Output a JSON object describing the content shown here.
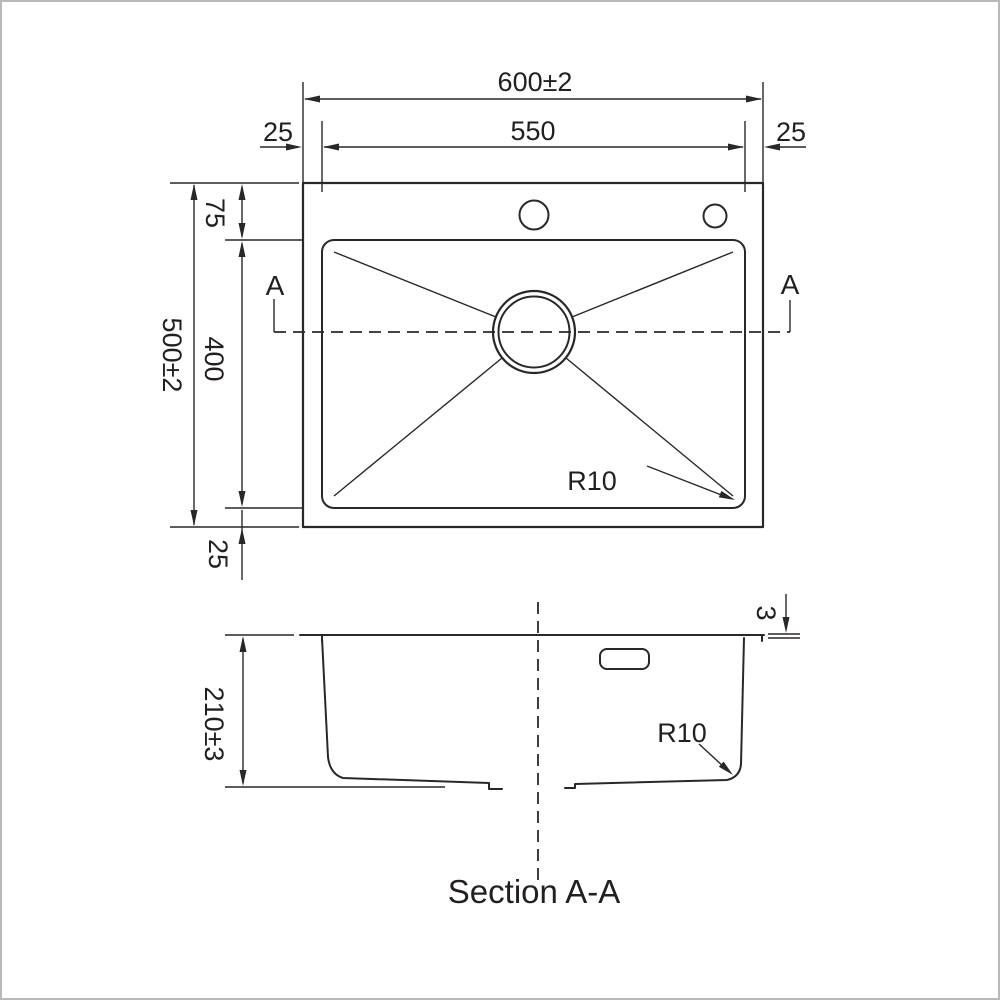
{
  "drawing": {
    "top_view": {
      "overall_width_dim": "600±2",
      "bowl_width_dim": "550",
      "left_margin_dim": "25",
      "right_margin_dim": "25",
      "overall_height_dim": "500±2",
      "top_margin_dim": "75",
      "bowl_height_dim": "400",
      "bottom_margin_dim": "25",
      "corner_radius_label": "R10",
      "section_marker_left": "A",
      "section_marker_right": "A"
    },
    "section_view": {
      "depth_dim": "210±3",
      "rim_thickness_dim": "3",
      "corner_radius_label": "R10",
      "caption": "Section A-A"
    },
    "colors": {
      "line": "#2b2727",
      "background": "#ffffff",
      "frame": "#b9b9b9"
    }
  }
}
